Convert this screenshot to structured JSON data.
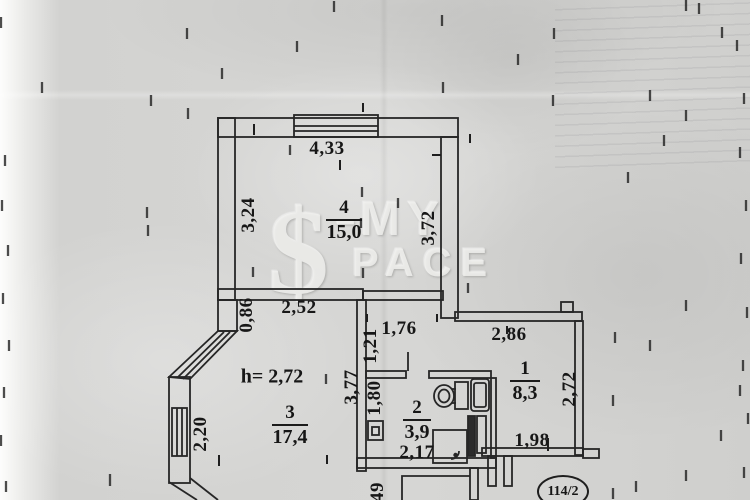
{
  "watermark": {
    "symbol": "$",
    "dash": "–",
    "word_top": "MY",
    "word_bottom": "PACE"
  },
  "stamp": {
    "number": "114/2"
  },
  "plan": {
    "ceiling_height_note": "h= 2,72",
    "rooms": {
      "room1": {
        "number": "1",
        "area": "8,3"
      },
      "room2": {
        "number": "2",
        "area": "3,9"
      },
      "room3": {
        "number": "3",
        "area": "17,4"
      },
      "room4": {
        "number": "4",
        "area": "15,0"
      }
    },
    "dimensions": {
      "room4_top": "4,33",
      "room4_left": "3,24",
      "room4_right": "3,72",
      "room3_top": "2,52",
      "room3_left_upper": "0,86",
      "room3_left": "2,20",
      "corridor_width": "1,76",
      "corridor_left": "1,21",
      "corridor_length": "3,77",
      "room1_top": "2,86",
      "room1_right": "2,72",
      "room1_bottom": "1,98",
      "room2_left": "1,80",
      "room2_bottom": "2,17",
      "hall_width_partial": "49"
    },
    "colors": {
      "ink": "#222222",
      "paper": "#d4d4d2"
    }
  }
}
